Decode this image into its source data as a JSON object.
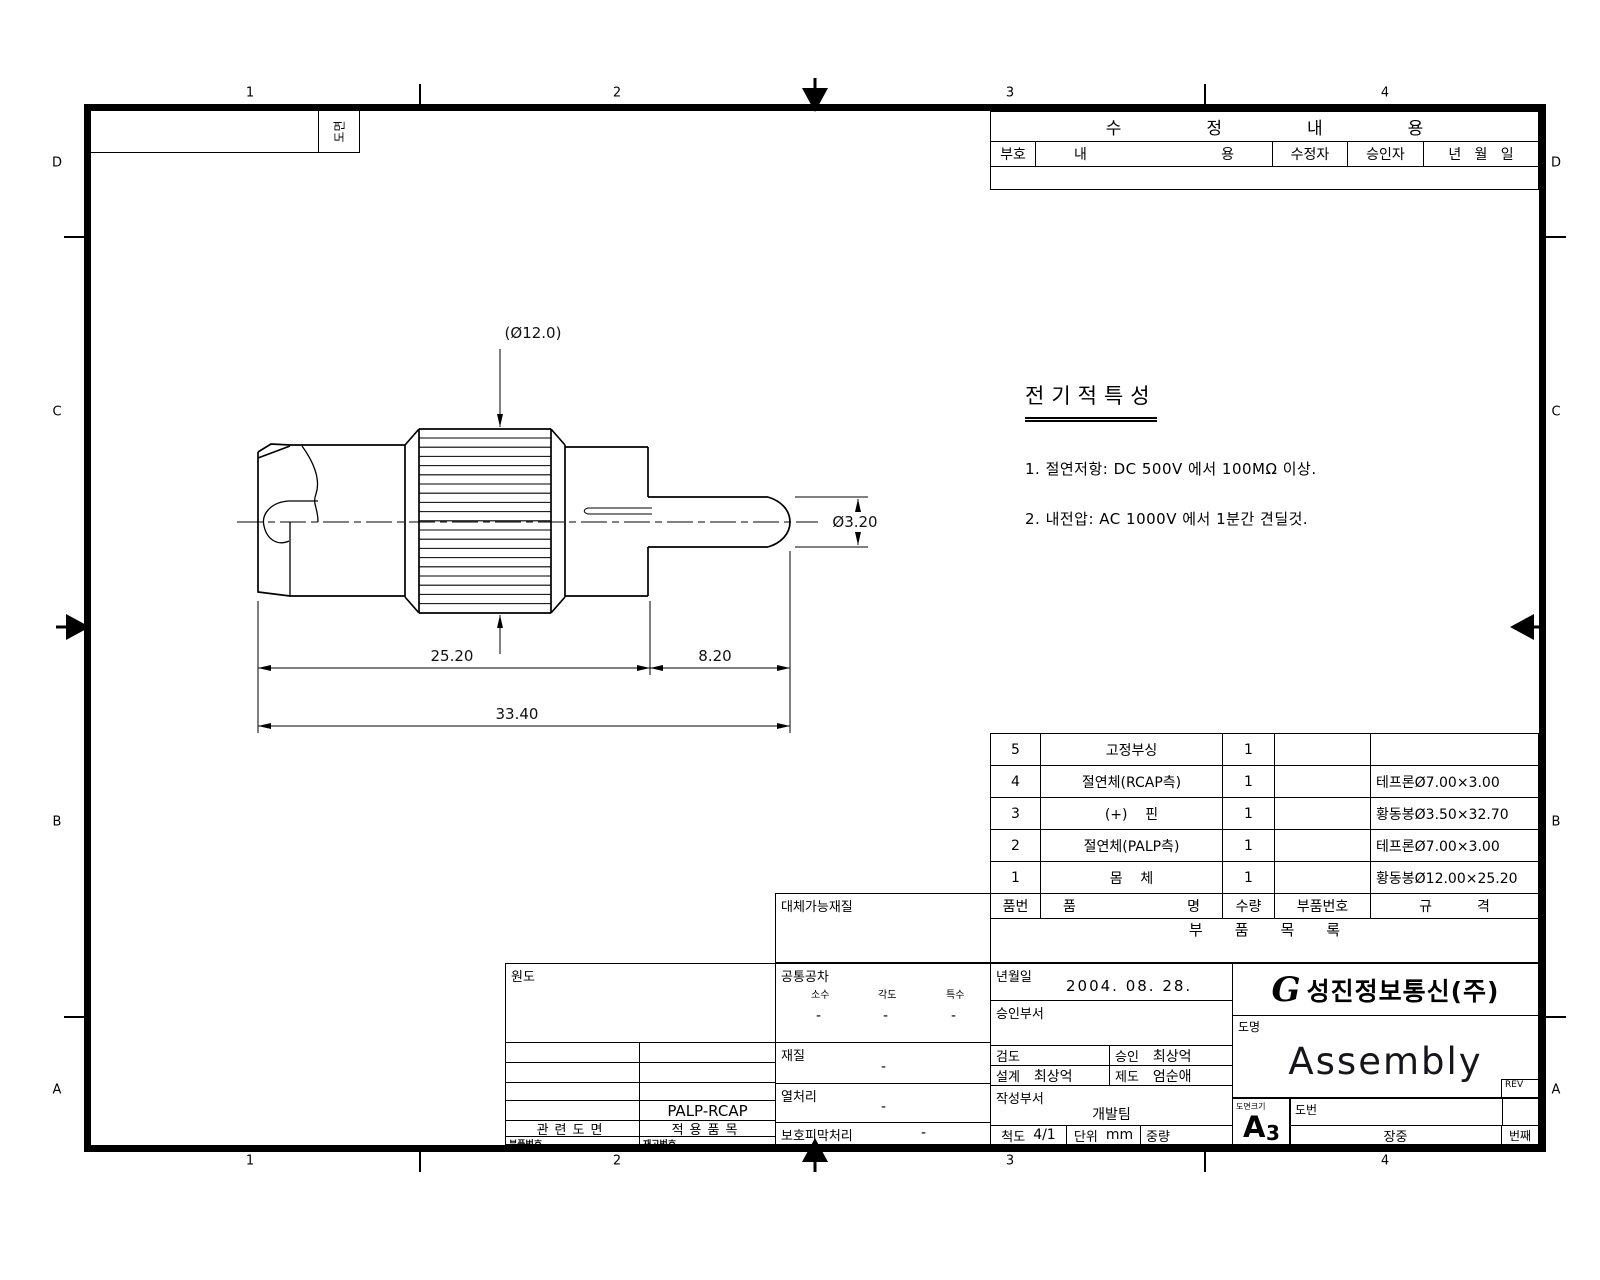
{
  "sheet": {
    "zones_h": [
      "1",
      "2",
      "3",
      "4"
    ],
    "zones_v": [
      "D",
      "C",
      "B",
      "A"
    ],
    "corner_label": "도면"
  },
  "revision": {
    "title": "수정내용",
    "col_no": "부호",
    "col_content_l": "내",
    "col_content_r": "용",
    "col_reviser": "수정자",
    "col_approver": "승인자",
    "col_date": "년   월   일"
  },
  "electrical": {
    "title": "전기적특성",
    "note1": "1. 절연저항: DC 500V 에서 100MΩ 이상.",
    "note2": "2. 내전압: AC 1000V 에서 1분간 견딜것."
  },
  "drawing": {
    "dim_knurl_dia": "(Ø12.0)",
    "dim_pin_dia": "Ø3.20",
    "dim_body_len": "25.20",
    "dim_pin_len": "8.20",
    "dim_total_len": "33.40"
  },
  "parts": {
    "h_no": "품번",
    "h_name_l": "품",
    "h_name_r": "명",
    "h_qty": "수량",
    "h_part_no": "부품번호",
    "h_spec_l": "규",
    "h_spec_r": "격",
    "footer": "부품목록",
    "rows": [
      {
        "no": "5",
        "name": "고정부싱",
        "qty": "1",
        "part_no": "",
        "spec": ""
      },
      {
        "no": "4",
        "name": "절연체(RCAP측)",
        "qty": "1",
        "part_no": "",
        "spec": "테프론Ø7.00×3.00"
      },
      {
        "no": "3",
        "name": "(+)    핀",
        "qty": "1",
        "part_no": "",
        "spec": "황동봉Ø3.50×32.70"
      },
      {
        "no": "2",
        "name": "절연체(PALP측)",
        "qty": "1",
        "part_no": "",
        "spec": "테프론Ø7.00×3.00"
      },
      {
        "no": "1",
        "name": "몸    체",
        "qty": "1",
        "part_no": "",
        "spec": "황동봉Ø12.00×25.20"
      }
    ]
  },
  "titleblock": {
    "alt_material": "대체가능재질",
    "origin": "원도",
    "tol_title": "공통공차",
    "tol_c1": "소수",
    "tol_c2": "각도",
    "tol_c3": "특수",
    "tol_v1": "-",
    "tol_v2": "-",
    "tol_v3": "-",
    "material_l": "재질",
    "material_v": "-",
    "heat_l": "열처리",
    "heat_v": "-",
    "coat_l": "보호피막처리",
    "coat_v": "-",
    "date_l": "년월일",
    "date_v": "2004. 08. 28.",
    "appr_dept_l": "승인부서",
    "check_l": "검도",
    "check_v": "",
    "approve_l": "승인",
    "approve_v": "최상억",
    "design_l": "설계",
    "design_v": "최상억",
    "draft_l": "제도",
    "draft_v": "엄순애",
    "write_dept_l": "작성부서",
    "write_dept_v": "개발팀",
    "scale_l": "척도",
    "scale_v": "4/1",
    "unit_l": "단위",
    "unit_v": "mm",
    "weight_l": "중량",
    "applied_value": "PALP-RCAP",
    "related_drawing": "관련도면",
    "applied_item": "적용품목",
    "part_no_small": "부품번호",
    "stock_no_small": "재고번호",
    "company": "성진정보통신(주)",
    "logo_mark": "G",
    "dwg_name_l": "도명",
    "dwg_name_v": "Assembly",
    "rev": "REV",
    "size_l": "도면크기",
    "size_v_a": "A",
    "size_v_3": "3",
    "dwg_no_l": "도번",
    "sheet_of": "장중",
    "sheet_nth": "번째"
  }
}
